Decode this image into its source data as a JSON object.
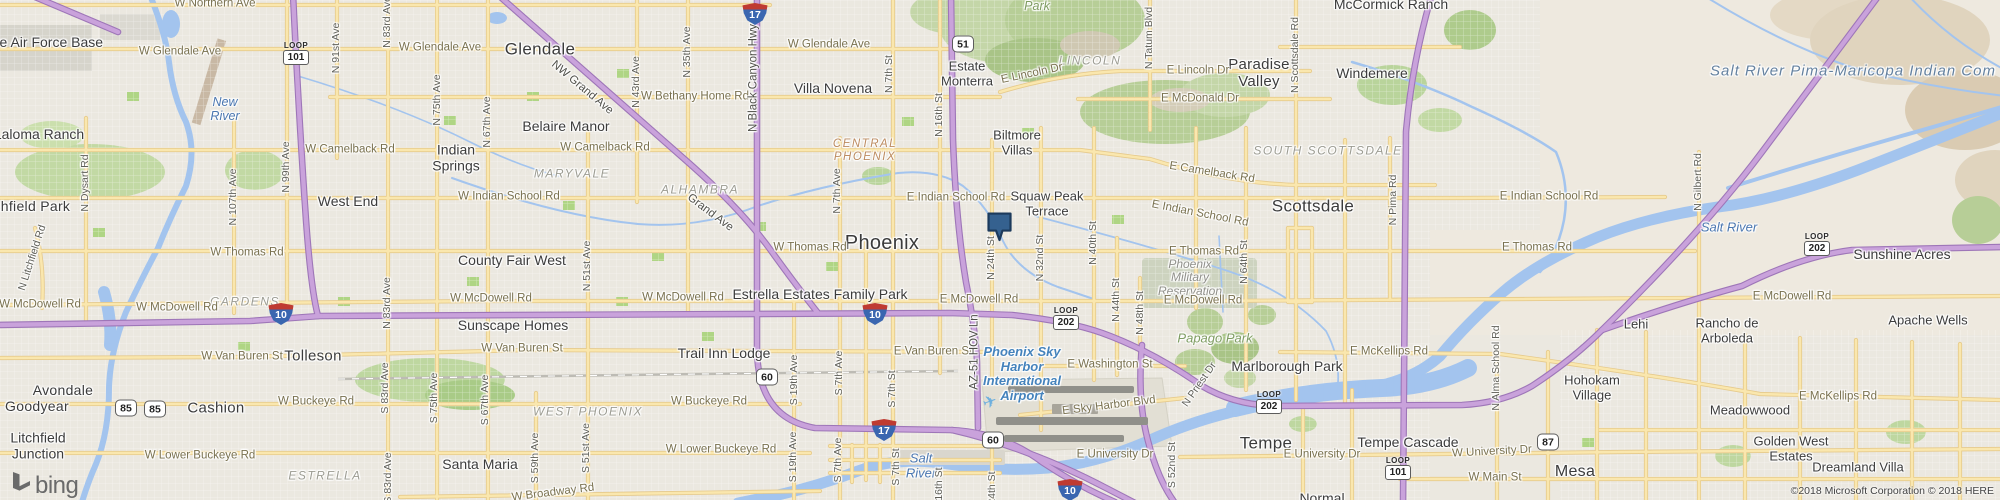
{
  "attribution": "©2018 Microsoft Corporation © 2018 HERE",
  "logo_text": "bing",
  "colors": {
    "land": "#EBE8E0",
    "desert": "#EEE9DF",
    "water": "#A3C4EE",
    "park_green": "#B7CE97",
    "arterial": "#FAE7AE",
    "freeway": "#C9A2DB",
    "marker_fill": "#35618F",
    "marker_border": "#1C3A5C"
  },
  "marker": {
    "x": 1000,
    "y": 233
  },
  "labels": [
    {
      "t": "Glendale",
      "x": 540,
      "y": 49,
      "k": "city",
      "s": 17
    },
    {
      "t": "Phoenix",
      "x": 882,
      "y": 243,
      "k": "city",
      "s": 20
    },
    {
      "t": "Scottsdale",
      "x": 1313,
      "y": 206,
      "k": "city",
      "s": 17
    },
    {
      "t": "Tempe",
      "x": 1266,
      "y": 443,
      "k": "city",
      "s": 17
    },
    {
      "t": "Mesa",
      "x": 1575,
      "y": 472,
      "k": "city",
      "s": 16
    },
    {
      "t": "Tolleson",
      "x": 313,
      "y": 357,
      "k": "city",
      "s": 15
    },
    {
      "t": "Avondale",
      "x": 63,
      "y": 391,
      "k": "city",
      "s": 14
    },
    {
      "t": "Goodyear",
      "x": 37,
      "y": 407,
      "k": "city",
      "s": 14
    },
    {
      "t": "Cashion",
      "x": 216,
      "y": 409,
      "k": "city",
      "s": 15
    },
    {
      "t": "Paradise\nValley",
      "x": 1259,
      "y": 74,
      "k": "city",
      "s": 15
    },
    {
      "t": "Litchfield Park",
      "x": 24,
      "y": 207,
      "k": "city",
      "s": 14
    },
    {
      "t": "Luke Air Force Base",
      "x": 40,
      "y": 43,
      "k": "nb",
      "s": 14
    },
    {
      "t": "Laloma Ranch",
      "x": 39,
      "y": 135,
      "k": "nb",
      "s": 14
    },
    {
      "t": "West End",
      "x": 348,
      "y": 202,
      "k": "nb",
      "s": 14
    },
    {
      "t": "Indian\nSprings",
      "x": 456,
      "y": 158,
      "k": "nb",
      "s": 14
    },
    {
      "t": "Belaire Manor",
      "x": 566,
      "y": 127,
      "k": "nb",
      "s": 14
    },
    {
      "t": "Villa Novena",
      "x": 833,
      "y": 89,
      "k": "nb",
      "s": 14
    },
    {
      "t": "Estate\nMonterra",
      "x": 967,
      "y": 74,
      "k": "nb",
      "s": 13
    },
    {
      "t": "Biltmore\nVillas",
      "x": 1017,
      "y": 143,
      "k": "nb",
      "s": 13
    },
    {
      "t": "Squaw Peak\nTerrace",
      "x": 1047,
      "y": 204,
      "k": "nb",
      "s": 13
    },
    {
      "t": "McCormick Ranch",
      "x": 1391,
      "y": 5,
      "k": "nb",
      "s": 14
    },
    {
      "t": "Windemere",
      "x": 1372,
      "y": 74,
      "k": "nb",
      "s": 14
    },
    {
      "t": "County Fair West",
      "x": 512,
      "y": 261,
      "k": "nb",
      "s": 14
    },
    {
      "t": "Sunscape Homes",
      "x": 513,
      "y": 326,
      "k": "nb",
      "s": 14
    },
    {
      "t": "Trail Inn Lodge",
      "x": 724,
      "y": 354,
      "k": "nb",
      "s": 14
    },
    {
      "t": "Santa Maria",
      "x": 480,
      "y": 465,
      "k": "nb",
      "s": 14
    },
    {
      "t": "Estrella Estates Family Park",
      "x": 820,
      "y": 295,
      "k": "nb",
      "s": 14
    },
    {
      "t": "Marlborough Park",
      "x": 1287,
      "y": 367,
      "k": "nb",
      "s": 14
    },
    {
      "t": "Tempe Cascade",
      "x": 1408,
      "y": 443,
      "k": "nb",
      "s": 14
    },
    {
      "t": "Sunshine Acres",
      "x": 1902,
      "y": 255,
      "k": "nb",
      "s": 14
    },
    {
      "t": "Apache Wells",
      "x": 1928,
      "y": 321,
      "k": "nb",
      "s": 13
    },
    {
      "t": "Lehi",
      "x": 1636,
      "y": 325,
      "k": "nb",
      "s": 13
    },
    {
      "t": "Rancho de\nArboleda",
      "x": 1727,
      "y": 331,
      "k": "nb",
      "s": 13
    },
    {
      "t": "Hohokam\nVillage",
      "x": 1592,
      "y": 388,
      "k": "nb",
      "s": 13
    },
    {
      "t": "Meadowwood",
      "x": 1750,
      "y": 411,
      "k": "nb",
      "s": 13
    },
    {
      "t": "Golden West\nEstates",
      "x": 1791,
      "y": 449,
      "k": "nb",
      "s": 13
    },
    {
      "t": "Dreamland Villa",
      "x": 1858,
      "y": 468,
      "k": "nb",
      "s": 13
    },
    {
      "t": "Litchfield\nJunction",
      "x": 38,
      "y": 446,
      "k": "nb",
      "s": 14
    },
    {
      "t": "Normal",
      "x": 1322,
      "y": 499,
      "k": "nb",
      "s": 14
    },
    {
      "t": "MARYVALE",
      "x": 572,
      "y": 174,
      "k": "dist"
    },
    {
      "t": "ALHAMBRA",
      "x": 700,
      "y": 190,
      "k": "dist"
    },
    {
      "t": "GARDENS",
      "x": 245,
      "y": 302,
      "k": "dist"
    },
    {
      "t": "ESTRELLA",
      "x": 325,
      "y": 476,
      "k": "dist"
    },
    {
      "t": "WEST PHOENIX",
      "x": 588,
      "y": 412,
      "k": "dist"
    },
    {
      "t": "SOUTH SCOTTSDALE",
      "x": 1328,
      "y": 151,
      "k": "dist"
    },
    {
      "t": "LINCOLN",
      "x": 1090,
      "y": 61,
      "k": "dist"
    },
    {
      "t": "CENTRAL\nPHOENIX",
      "x": 865,
      "y": 151,
      "k": "distc"
    },
    {
      "t": "Phoenix\nMilitary\nReservation",
      "x": 1190,
      "y": 278,
      "k": "area"
    },
    {
      "t": "Papago Park",
      "x": 1215,
      "y": 339,
      "k": "park",
      "s": 13
    },
    {
      "t": "Park",
      "x": 1037,
      "y": 6,
      "k": "park"
    },
    {
      "t": "New\nRiver",
      "x": 225,
      "y": 109,
      "k": "water"
    },
    {
      "t": "Salt River",
      "x": 1729,
      "y": 228,
      "k": "water",
      "s": 13
    },
    {
      "t": "Salt\nRiver",
      "x": 921,
      "y": 466,
      "k": "water",
      "s": 13
    },
    {
      "t": "Salt River Pima-Maricopa Indian Com",
      "x": 1853,
      "y": 72,
      "k": "waterb"
    },
    {
      "t": "Phoenix Sky\nHarbor\nInternational\nAirport",
      "x": 1022,
      "y": 374,
      "k": "air"
    },
    {
      "t": "✈",
      "x": 990,
      "y": 402,
      "k": "plane",
      "r": -20
    },
    {
      "t": "W Northern Ave",
      "x": 215,
      "y": 4,
      "k": "road"
    },
    {
      "t": "W Glendale Ave",
      "x": 180,
      "y": 52,
      "k": "road"
    },
    {
      "t": "W Glendale Ave",
      "x": 440,
      "y": 48,
      "k": "road"
    },
    {
      "t": "W Glendale Ave",
      "x": 829,
      "y": 45,
      "k": "road"
    },
    {
      "t": "W Bethany Home Rd",
      "x": 695,
      "y": 97,
      "k": "road"
    },
    {
      "t": "W Camelback Rd",
      "x": 350,
      "y": 150,
      "k": "road"
    },
    {
      "t": "W Camelback Rd",
      "x": 605,
      "y": 148,
      "k": "road"
    },
    {
      "t": "E Camelback Rd",
      "x": 1212,
      "y": 173,
      "k": "road",
      "r": 9
    },
    {
      "t": "W Indian School Rd",
      "x": 509,
      "y": 197,
      "k": "road"
    },
    {
      "t": "E Indian School Rd",
      "x": 956,
      "y": 198,
      "k": "road"
    },
    {
      "t": "E Indian School Rd",
      "x": 1200,
      "y": 214,
      "k": "road",
      "r": 11
    },
    {
      "t": "E Indian School Rd",
      "x": 1549,
      "y": 197,
      "k": "road"
    },
    {
      "t": "W Thomas Rd",
      "x": 247,
      "y": 253,
      "k": "road"
    },
    {
      "t": "W Thomas Rd",
      "x": 810,
      "y": 248,
      "k": "road"
    },
    {
      "t": "E Thomas Rd",
      "x": 1204,
      "y": 252,
      "k": "road"
    },
    {
      "t": "E Thomas Rd",
      "x": 1537,
      "y": 248,
      "k": "road"
    },
    {
      "t": "W McDowell Rd",
      "x": 40,
      "y": 305,
      "k": "road"
    },
    {
      "t": "W McDowell Rd",
      "x": 177,
      "y": 308,
      "k": "road"
    },
    {
      "t": "W McDowell Rd",
      "x": 491,
      "y": 299,
      "k": "road"
    },
    {
      "t": "W McDowell Rd",
      "x": 683,
      "y": 298,
      "k": "road"
    },
    {
      "t": "E McDowell Rd",
      "x": 979,
      "y": 300,
      "k": "road"
    },
    {
      "t": "E McDowell Rd",
      "x": 1203,
      "y": 301,
      "k": "road"
    },
    {
      "t": "E McDowell Rd",
      "x": 1792,
      "y": 297,
      "k": "road"
    },
    {
      "t": "W Van Buren St",
      "x": 242,
      "y": 357,
      "k": "road"
    },
    {
      "t": "W Van Buren St",
      "x": 522,
      "y": 349,
      "k": "road"
    },
    {
      "t": "E Van Buren St",
      "x": 933,
      "y": 352,
      "k": "road"
    },
    {
      "t": "E Washington St",
      "x": 1110,
      "y": 365,
      "k": "road"
    },
    {
      "t": "W Buckeye Rd",
      "x": 316,
      "y": 402,
      "k": "road"
    },
    {
      "t": "W Buckeye Rd",
      "x": 709,
      "y": 402,
      "k": "road"
    },
    {
      "t": "W Lower Buckeye Rd",
      "x": 200,
      "y": 456,
      "k": "road"
    },
    {
      "t": "W Lower Buckeye Rd",
      "x": 721,
      "y": 450,
      "k": "road"
    },
    {
      "t": "W Broadway Rd",
      "x": 553,
      "y": 493,
      "k": "road",
      "r": -7
    },
    {
      "t": "E Sky Harbor Blvd",
      "x": 1109,
      "y": 406,
      "k": "road",
      "r": -7
    },
    {
      "t": "E University Dr",
      "x": 1115,
      "y": 455,
      "k": "road"
    },
    {
      "t": "E University Dr",
      "x": 1322,
      "y": 455,
      "k": "road"
    },
    {
      "t": "W University Dr",
      "x": 1492,
      "y": 452,
      "k": "road",
      "r": -3
    },
    {
      "t": "W Main St",
      "x": 1495,
      "y": 478,
      "k": "road"
    },
    {
      "t": "E McKellips Rd",
      "x": 1389,
      "y": 352,
      "k": "road"
    },
    {
      "t": "E McKellips Rd",
      "x": 1838,
      "y": 397,
      "k": "road"
    },
    {
      "t": "E Lincoln Dr",
      "x": 1032,
      "y": 74,
      "k": "road",
      "r": -12
    },
    {
      "t": "E Lincoln Dr",
      "x": 1198,
      "y": 71,
      "k": "road"
    },
    {
      "t": "E McDonald Dr",
      "x": 1200,
      "y": 99,
      "k": "road"
    },
    {
      "t": "N 91st Ave",
      "x": 337,
      "y": 48,
      "k": "roadv"
    },
    {
      "t": "N 83rd Ave",
      "x": 388,
      "y": 22,
      "k": "roadv"
    },
    {
      "t": "N 83rd Ave",
      "x": 388,
      "y": 303,
      "k": "roadv"
    },
    {
      "t": "N 75th Ave",
      "x": 438,
      "y": 100,
      "k": "roadv"
    },
    {
      "t": "N 67th Ave",
      "x": 488,
      "y": 122,
      "k": "roadv"
    },
    {
      "t": "N 51st Ave",
      "x": 588,
      "y": 266,
      "k": "roadv"
    },
    {
      "t": "N 43rd Ave",
      "x": 637,
      "y": 82,
      "k": "roadv"
    },
    {
      "t": "N 35th Ave",
      "x": 688,
      "y": 52,
      "k": "roadv"
    },
    {
      "t": "N 7th Ave",
      "x": 838,
      "y": 191,
      "k": "roadv"
    },
    {
      "t": "N 7th St",
      "x": 890,
      "y": 74,
      "k": "roadv"
    },
    {
      "t": "N 16th St",
      "x": 940,
      "y": 115,
      "k": "roadv"
    },
    {
      "t": "N 24th St",
      "x": 992,
      "y": 258,
      "k": "roadv"
    },
    {
      "t": "N 32nd St",
      "x": 1041,
      "y": 258,
      "k": "roadv"
    },
    {
      "t": "N 40th St",
      "x": 1094,
      "y": 243,
      "k": "roadv"
    },
    {
      "t": "N 44th St",
      "x": 1117,
      "y": 300,
      "k": "roadv"
    },
    {
      "t": "N 48th St",
      "x": 1141,
      "y": 313,
      "k": "roadv"
    },
    {
      "t": "N 64th St",
      "x": 1245,
      "y": 262,
      "k": "roadv"
    },
    {
      "t": "N Tatum Blvd",
      "x": 1150,
      "y": 38,
      "k": "roadv"
    },
    {
      "t": "N Scottsdale Rd",
      "x": 1296,
      "y": 55,
      "k": "roadv"
    },
    {
      "t": "N Pima Rd",
      "x": 1394,
      "y": 200,
      "k": "roadv"
    },
    {
      "t": "N Gilbert Rd",
      "x": 1699,
      "y": 182,
      "k": "roadv"
    },
    {
      "t": "N Alma School Rd",
      "x": 1497,
      "y": 368,
      "k": "roadv"
    },
    {
      "t": "N Dysart Rd",
      "x": 86,
      "y": 183,
      "k": "roadv"
    },
    {
      "t": "N 99th Ave",
      "x": 287,
      "y": 167,
      "k": "roadv"
    },
    {
      "t": "N 107th Ave",
      "x": 234,
      "y": 197,
      "k": "roadv"
    },
    {
      "t": "S 83rd Ave",
      "x": 386,
      "y": 388,
      "k": "roadv"
    },
    {
      "t": "S 83rd Ave",
      "x": 389,
      "y": 478,
      "k": "roadv"
    },
    {
      "t": "S 75th Ave",
      "x": 435,
      "y": 398,
      "k": "roadv"
    },
    {
      "t": "S 67th Ave",
      "x": 486,
      "y": 400,
      "k": "roadv"
    },
    {
      "t": "S 59th Ave",
      "x": 536,
      "y": 458,
      "k": "roadv"
    },
    {
      "t": "S 51st Ave",
      "x": 587,
      "y": 448,
      "k": "roadv"
    },
    {
      "t": "S 19th Ave",
      "x": 795,
      "y": 380,
      "k": "roadv"
    },
    {
      "t": "S 19th Ave",
      "x": 794,
      "y": 457,
      "k": "roadv"
    },
    {
      "t": "S 7th Ave",
      "x": 840,
      "y": 373,
      "k": "roadv"
    },
    {
      "t": "S 7th Ave",
      "x": 839,
      "y": 460,
      "k": "roadv"
    },
    {
      "t": "S 7th St",
      "x": 893,
      "y": 389,
      "k": "roadv"
    },
    {
      "t": "S 7th St",
      "x": 897,
      "y": 467,
      "k": "roadv"
    },
    {
      "t": "S 16th St",
      "x": 940,
      "y": 489,
      "k": "roadv"
    },
    {
      "t": "S 24th St",
      "x": 993,
      "y": 493,
      "k": "roadv"
    },
    {
      "t": "S 52nd St",
      "x": 1173,
      "y": 465,
      "k": "roadv"
    },
    {
      "t": "N Litchfield Rd",
      "x": 33,
      "y": 258,
      "k": "roadv",
      "r": -72
    },
    {
      "t": "N Priest Dr",
      "x": 1200,
      "y": 385,
      "k": "roadv",
      "r": -55
    },
    {
      "t": "N Black Canyon Hwy",
      "x": 754,
      "y": 78,
      "k": "fwy",
      "r": -90
    },
    {
      "t": "NW Grand Ave",
      "x": 582,
      "y": 88,
      "k": "fwy",
      "r": 40
    },
    {
      "t": "Grand Ave",
      "x": 710,
      "y": 213,
      "k": "fwy",
      "r": 37
    },
    {
      "t": "AZ-51 HOV Ln",
      "x": 975,
      "y": 352,
      "k": "fwy",
      "r": -90
    }
  ],
  "shields": [
    {
      "type": "interstate",
      "num": "17",
      "x": 755,
      "y": 14
    },
    {
      "type": "interstate",
      "num": "17",
      "x": 884,
      "y": 430
    },
    {
      "type": "interstate",
      "num": "10",
      "x": 281,
      "y": 314
    },
    {
      "type": "interstate",
      "num": "10",
      "x": 875,
      "y": 314
    },
    {
      "type": "interstate",
      "num": "10",
      "x": 1070,
      "y": 490
    },
    {
      "type": "us",
      "num": "60",
      "x": 767,
      "y": 377
    },
    {
      "type": "us",
      "num": "60",
      "x": 993,
      "y": 440
    },
    {
      "type": "us",
      "num": "85",
      "x": 126,
      "y": 408
    },
    {
      "type": "us",
      "num": "85",
      "x": 155,
      "y": 409
    },
    {
      "type": "us",
      "num": "87",
      "x": 1548,
      "y": 442
    },
    {
      "type": "us",
      "num": "51",
      "x": 963,
      "y": 44
    },
    {
      "type": "loop",
      "word": "LOOP",
      "num": "101",
      "x": 296,
      "y": 53
    },
    {
      "type": "loop",
      "word": "LOOP",
      "num": "101",
      "x": 1398,
      "y": 468
    },
    {
      "type": "loop",
      "word": "LOOP",
      "num": "202",
      "x": 1066,
      "y": 318
    },
    {
      "type": "loop",
      "word": "LOOP",
      "num": "202",
      "x": 1269,
      "y": 402
    },
    {
      "type": "loop",
      "word": "LOOP",
      "num": "202",
      "x": 1817,
      "y": 244
    }
  ]
}
